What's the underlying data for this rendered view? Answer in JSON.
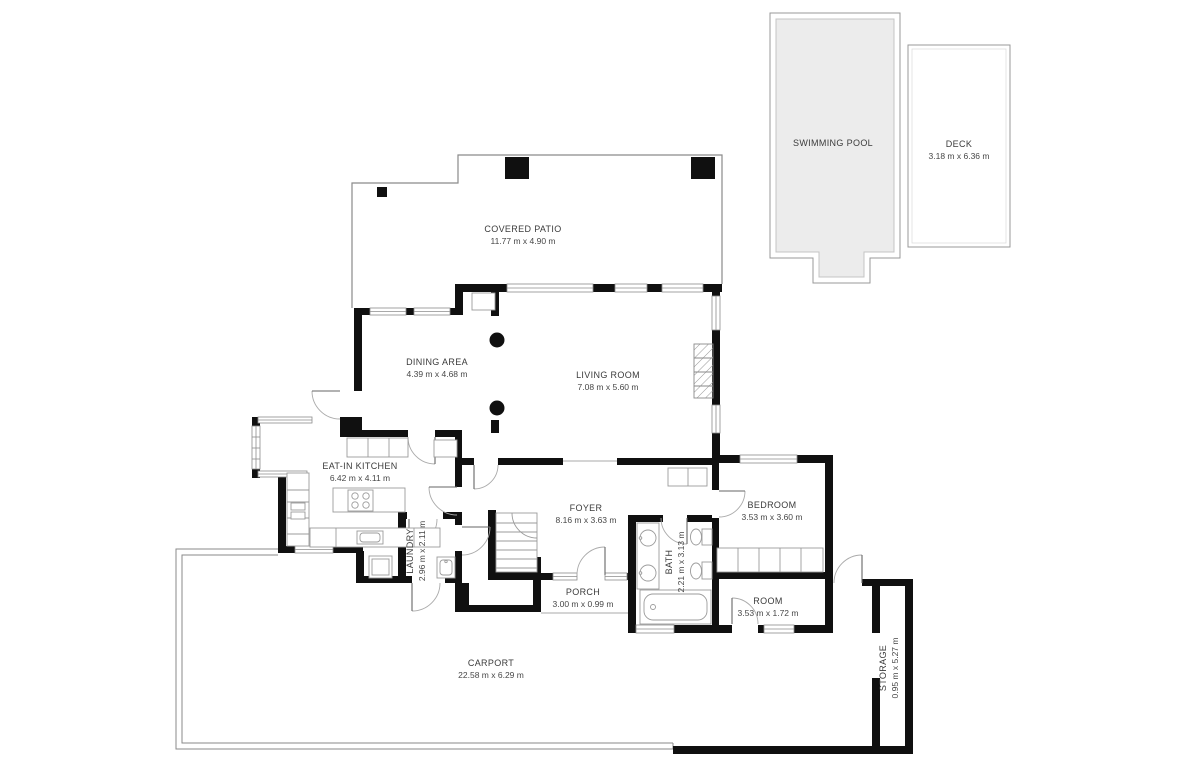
{
  "title": "Floor plan",
  "colors": {
    "wall": "#101010",
    "thin_outline": "#8a8a8a",
    "window_line": "#8c8c8c",
    "pool_fill": "#ececec",
    "label_text": "#3b3b3b"
  },
  "rooms": [
    {
      "id": "swimming-pool",
      "name": "SWIMMING POOL",
      "dims": ""
    },
    {
      "id": "deck",
      "name": "DECK",
      "dims": "3.18 m x 6.36 m"
    },
    {
      "id": "covered-patio",
      "name": "COVERED PATIO",
      "dims": "11.77 m x 4.90 m"
    },
    {
      "id": "dining-area",
      "name": "DINING AREA",
      "dims": "4.39 m x 4.68 m"
    },
    {
      "id": "living-room",
      "name": "LIVING ROOM",
      "dims": "7.08 m x 5.60 m"
    },
    {
      "id": "eat-in-kitchen",
      "name": "EAT-IN KITCHEN",
      "dims": "6.42 m x 4.11 m"
    },
    {
      "id": "foyer",
      "name": "FOYER",
      "dims": "8.16 m x 3.63 m"
    },
    {
      "id": "laundry",
      "name": "LAUNDRY",
      "dims": "2.96 m x 2.11 m"
    },
    {
      "id": "porch",
      "name": "PORCH",
      "dims": "3.00 m x 0.99 m"
    },
    {
      "id": "bath",
      "name": "BATH",
      "dims": "2.21 m x 3.13 m"
    },
    {
      "id": "bedroom",
      "name": "BEDROOM",
      "dims": "3.53 m x 3.60 m"
    },
    {
      "id": "room",
      "name": "ROOM",
      "dims": "3.53 m x 1.72 m"
    },
    {
      "id": "carport",
      "name": "CARPORT",
      "dims": "22.58 m x 6.29 m"
    },
    {
      "id": "storage",
      "name": "STORAGE",
      "dims": "0.95 m x 5.27 m"
    }
  ]
}
